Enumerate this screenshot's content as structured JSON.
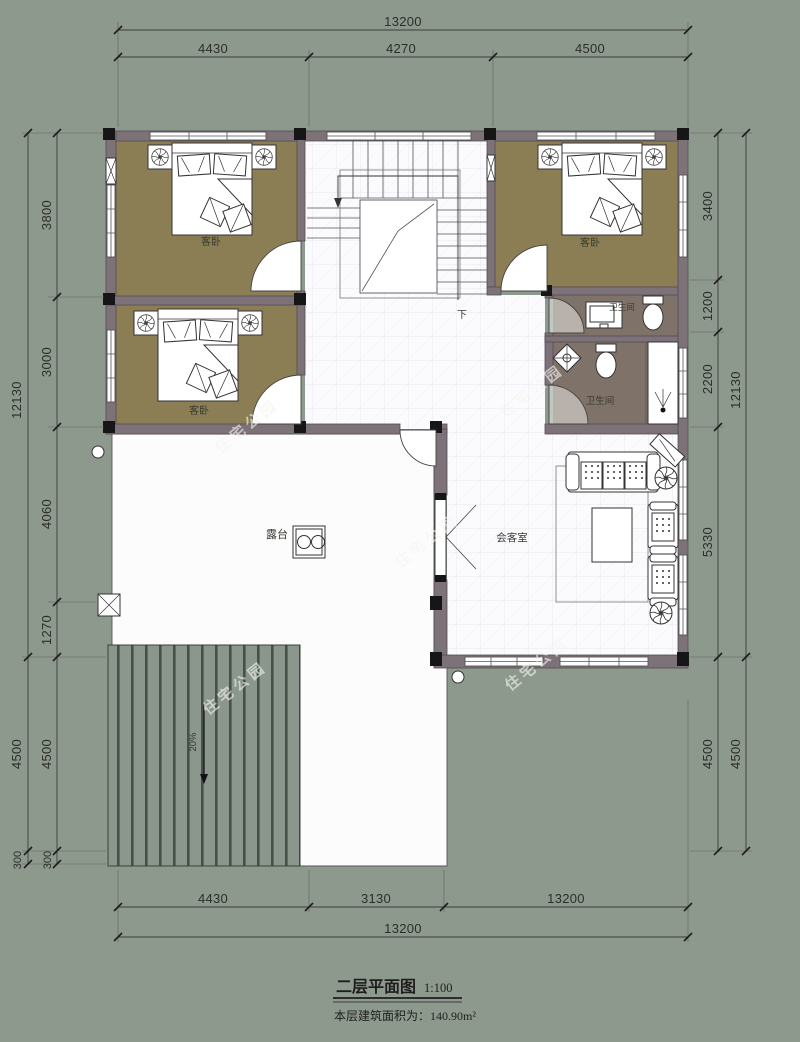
{
  "title_block": {
    "title": "二层平面图",
    "scale": "1:100",
    "area_label": "本层建筑面积为：140.90m²"
  },
  "watermark_text": "住宅公园",
  "rooms": {
    "bedroom_top_left": "客卧",
    "bedroom_mid_left": "客卧",
    "bedroom_top_right": "客卧",
    "bath_upper": "卫生间",
    "bath_lower": "卫生间",
    "living_room": "会客室",
    "terrace": "露台",
    "stairs_down": "下",
    "roof_slope": "20%"
  },
  "dimensions": {
    "top": {
      "overall": "13200",
      "segments": [
        "4430",
        "4270",
        "4500"
      ]
    },
    "bottom": {
      "segments": [
        "4430",
        "3130",
        "5640"
      ],
      "overall": "13200"
    },
    "left": {
      "outer": [
        "12130",
        "4500",
        "300"
      ],
      "inner": [
        "3800",
        "3000",
        "4060",
        "1270",
        "4500",
        "300"
      ]
    },
    "right": {
      "inner": [
        "3400",
        "1200",
        "2200",
        "5330",
        "4500"
      ],
      "outer": [
        "12130",
        "4500"
      ]
    }
  },
  "colors": {
    "background": "#8e998e",
    "wall": "#7d7278",
    "bedroom_floor": "#8c7e54",
    "bath_floor": "#7f7268",
    "roof_stripe": "#45504a"
  }
}
